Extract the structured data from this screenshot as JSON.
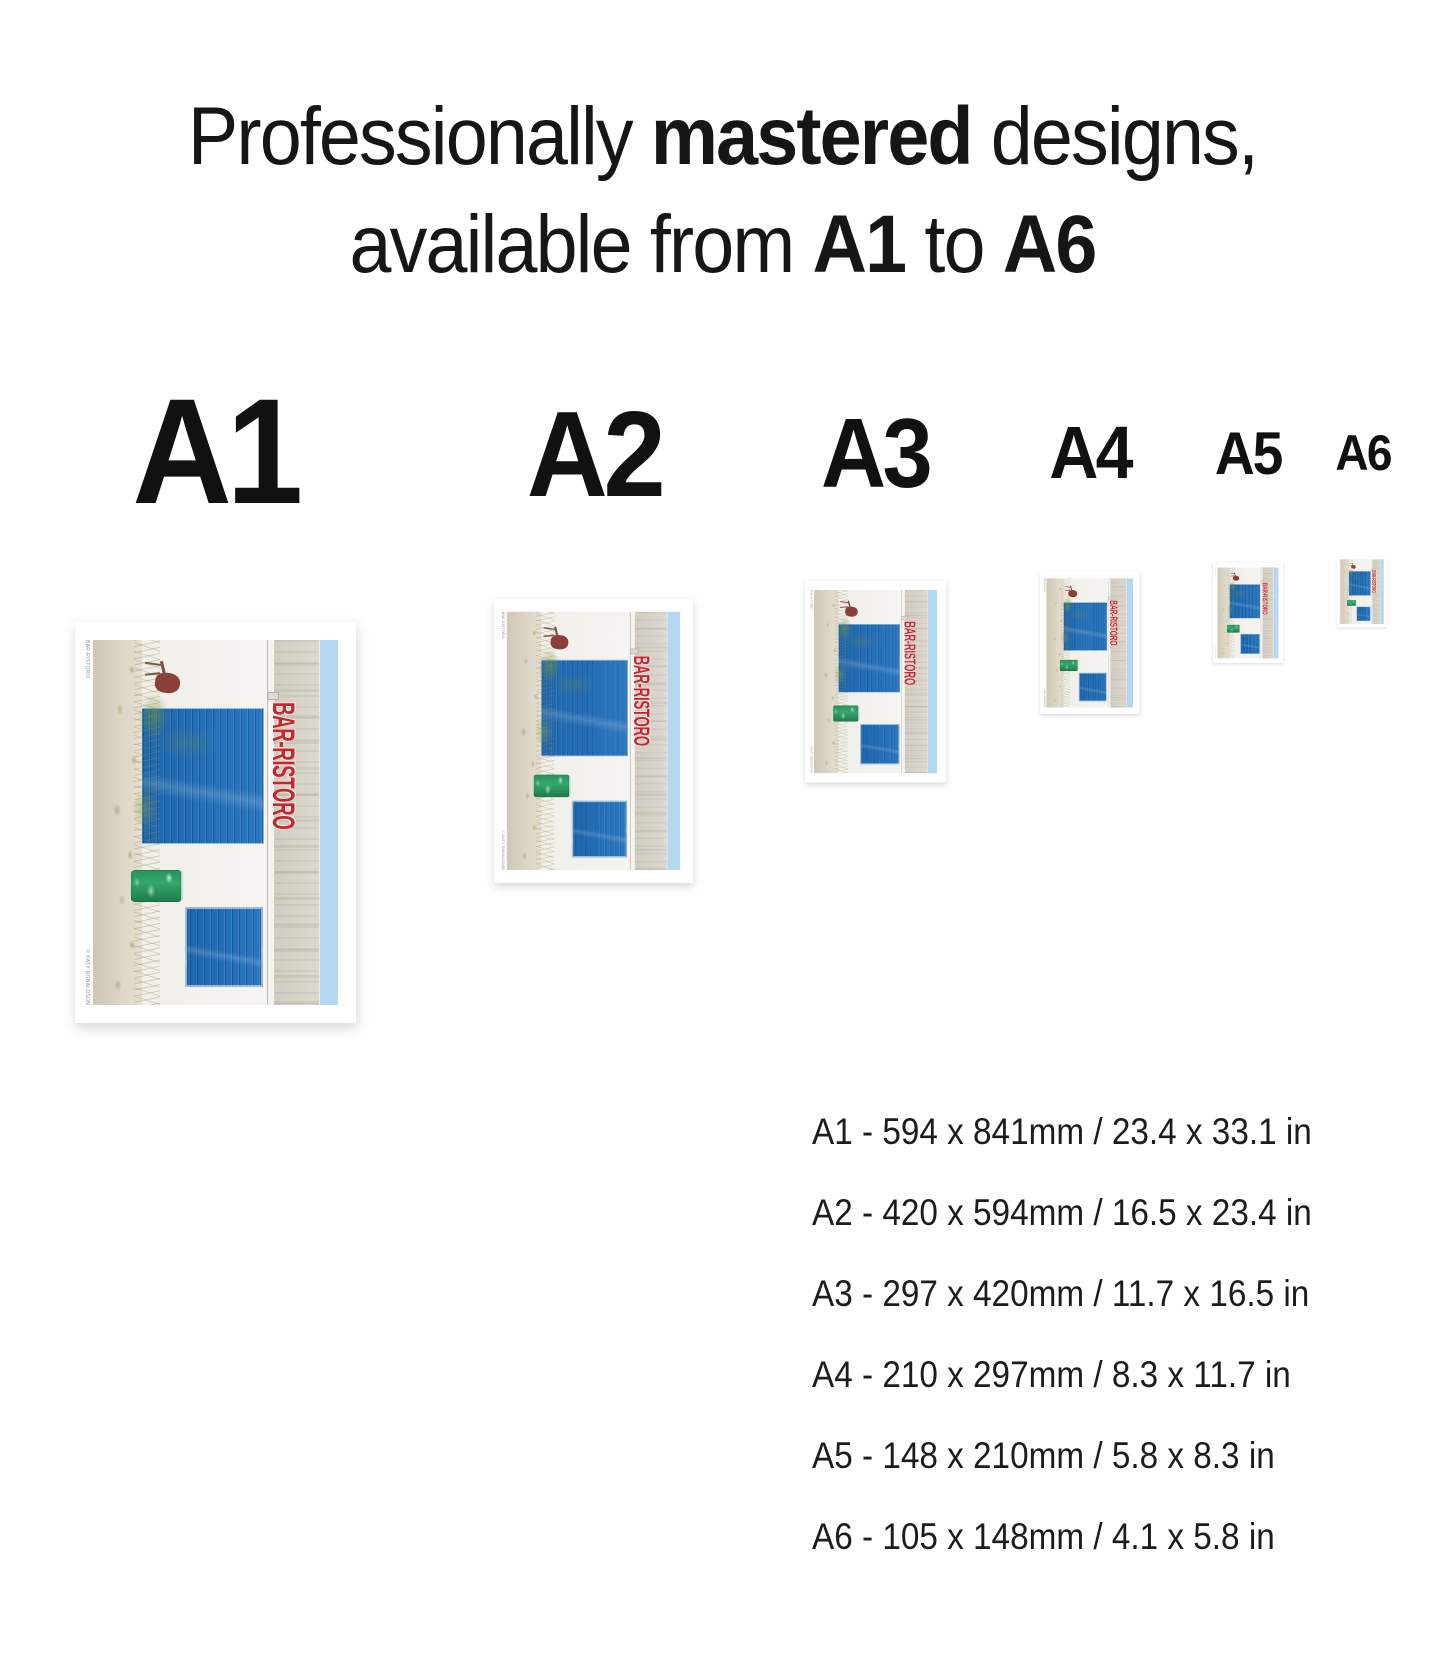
{
  "title": {
    "line1": [
      {
        "t": "Professionally ",
        "b": 0
      },
      {
        "t": "mastered",
        "b": 1
      },
      {
        "t": " designs,",
        "b": 0
      }
    ],
    "line2": [
      {
        "t": "available from ",
        "b": 0
      },
      {
        "t": "A1",
        "b": 1
      },
      {
        "t": " to ",
        "b": 0
      },
      {
        "t": "A6",
        "b": 1
      }
    ]
  },
  "poster": {
    "sign_text": "BAR-RISTORO",
    "caption_left": "BAR-RISTORO",
    "caption_right": "© KATY DONALDSON",
    "colors": {
      "door_blue": "#1d6eb8",
      "sign_red": "#c4272d",
      "sky_blue": "#b4d8f1",
      "barrel_green": "#2f9e63",
      "chair_maroon": "#8a4036"
    }
  },
  "sizes": [
    {
      "label": "A1",
      "spec": "A1 - 594 x 841mm / 23.4 x 33.1 in"
    },
    {
      "label": "A2",
      "spec": "A2 - 420 x 594mm / 16.5 x 23.4 in"
    },
    {
      "label": "A3",
      "spec": "A3 - 297 x 420mm / 11.7 x 16.5 in"
    },
    {
      "label": "A4",
      "spec": "A4 - 210 x 297mm / 8.3 x 11.7 in"
    },
    {
      "label": "A5",
      "spec": "A5 - 148 x 210mm / 5.8 x 8.3 in"
    },
    {
      "label": "A6",
      "spec": "A6 - 105 x 148mm / 4.1 x 5.8 in"
    }
  ]
}
